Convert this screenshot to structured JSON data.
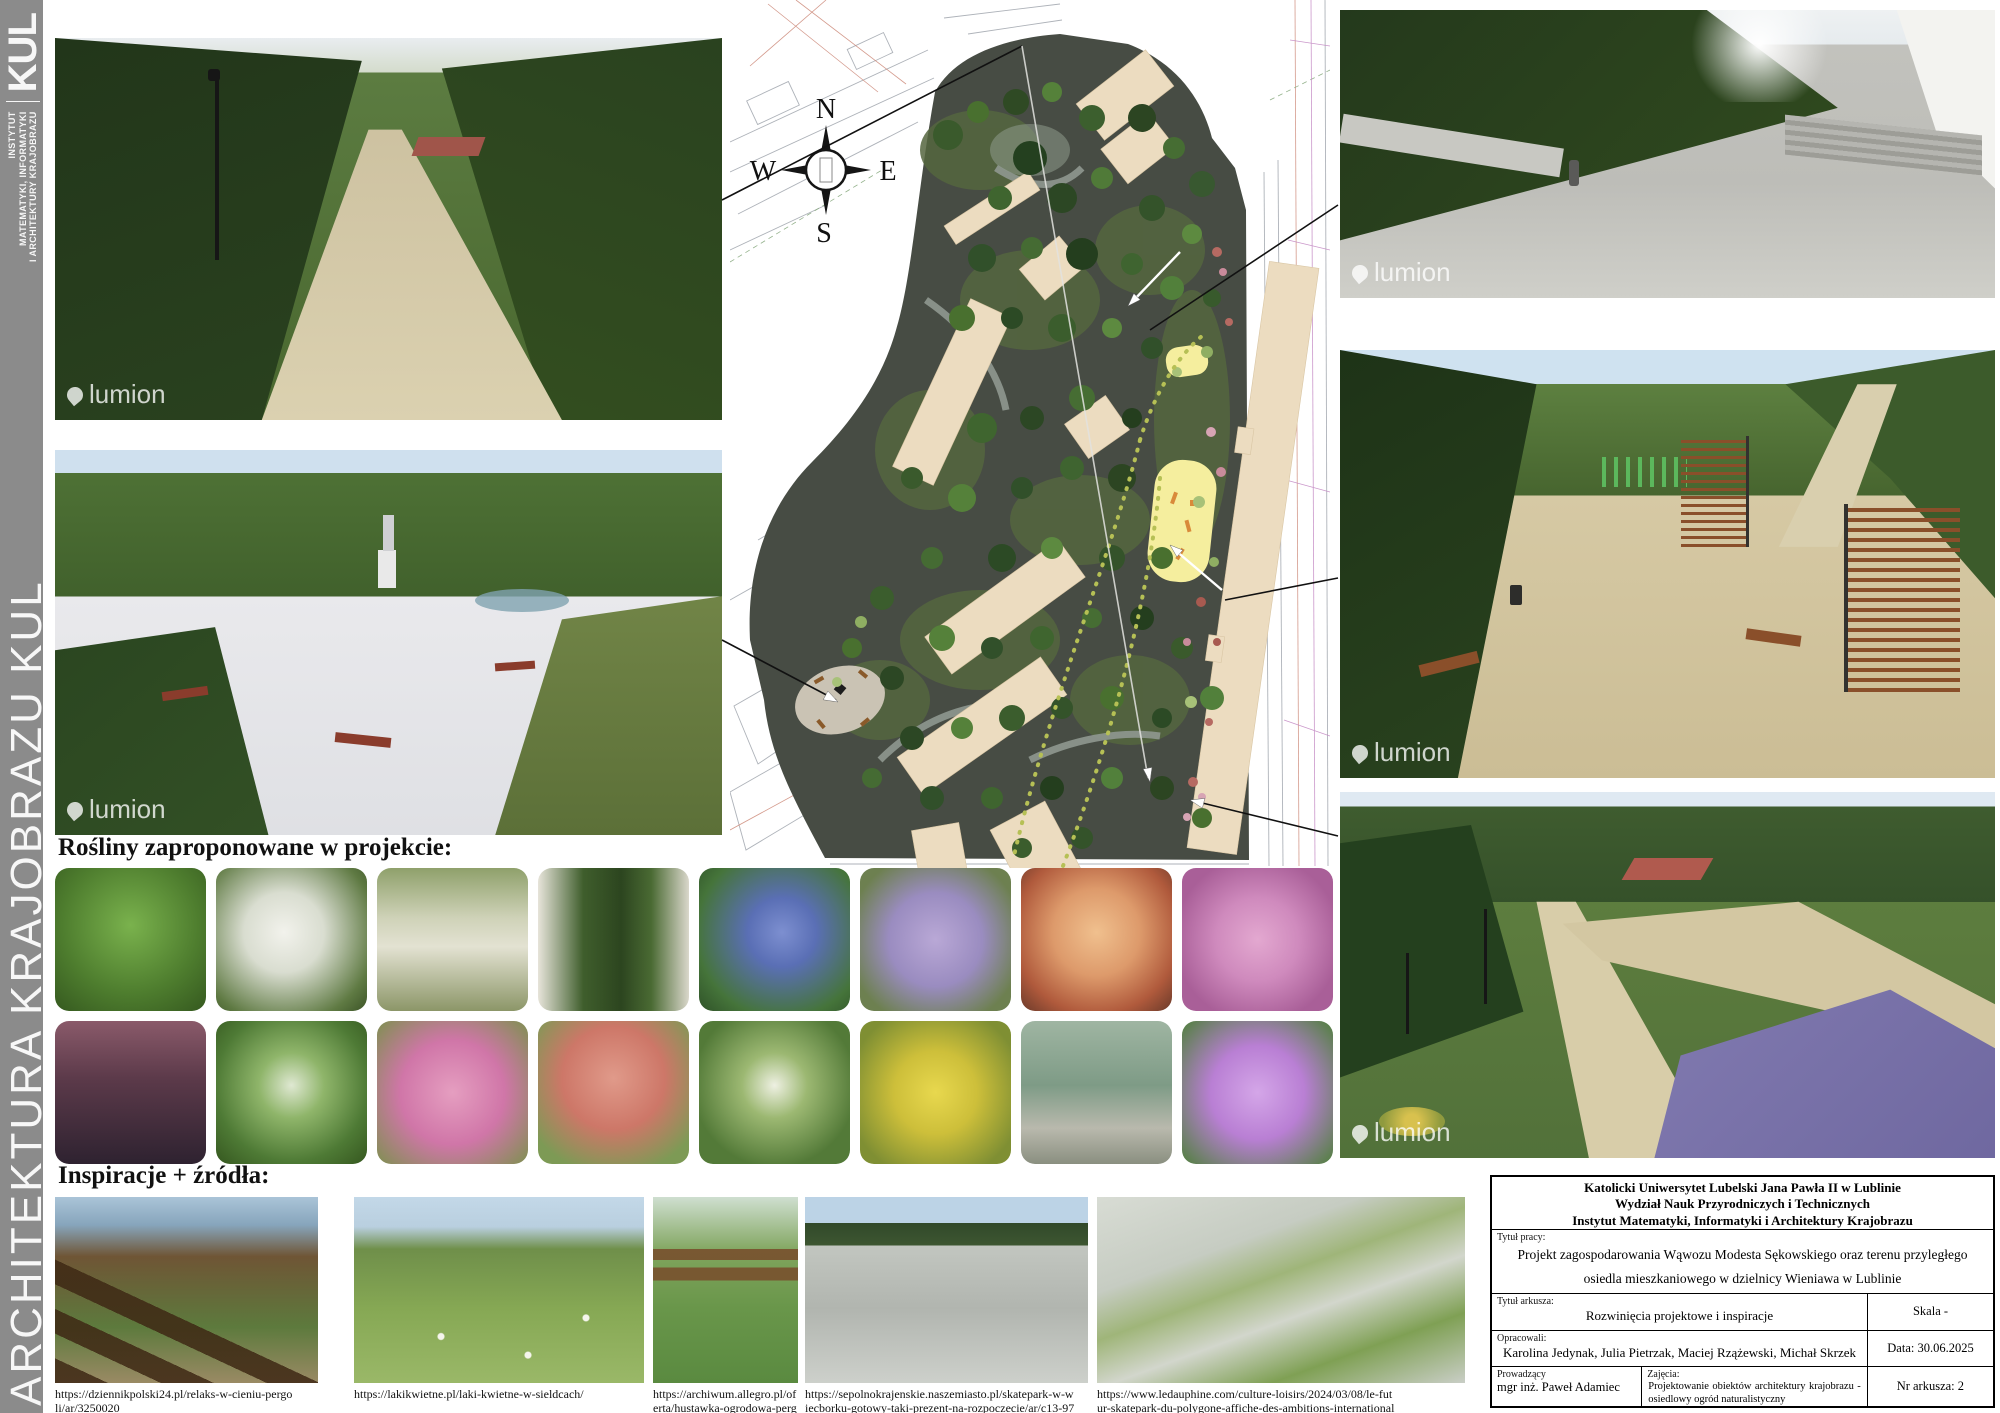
{
  "sidebar": {
    "bg_color": "#8b8b8b",
    "logo_text": "KUL",
    "institute_lines": [
      "INSTYTUT",
      "MATEMATYKI, INFORMATYKI",
      "I ARCHITEKTURY KRAJOBRAZU"
    ],
    "vertical_title": "ARCHITEKTURA KRAJOBRAZU KUL"
  },
  "headings": {
    "plants": "Rośliny zaproponowane w projekcie:",
    "inspirations": "Inspiracje + źródła:"
  },
  "compass": {
    "n": "N",
    "e": "E",
    "s": "S",
    "w": "W"
  },
  "watermark_text": "lumion",
  "plan_colors": {
    "ground": "#474c44",
    "building": "#ecdcc0",
    "play_area": "#f5ee9e",
    "dotted_path": "#b6c055"
  },
  "plants": {
    "tiles": [
      {
        "name": "green-ornamental-grass",
        "style": "background:radial-gradient(circle at 50% 40%,#7ab24d 0%,#4e7d2e 60%,#35591f 100%)"
      },
      {
        "name": "white-rhododendron",
        "style": "background:radial-gradient(circle at 45% 45%,#f2f2ec 0%,#d9ddd0 35%,#5f7a43 80%,#3c5427 100%)"
      },
      {
        "name": "silver-feather-grass",
        "style": "background:linear-gradient(180deg,#8fa06b 0%,#cfd2b8 35%,#e3e2d2 55%,#8c9668 100%)"
      },
      {
        "name": "ivy-covered-trunk",
        "style": "background:linear-gradient(90deg,#e7e4da 0%,#3f5e2c 30%,#2c451f 55%,#4a6a33 75%,#dad7cb 100%)"
      },
      {
        "name": "blue-periwinkle",
        "style": "background:radial-gradient(circle at 55% 45%,#7d8fd0 0%,#5a6fb5 30%,#45743a 75%,#2f5228 100%)"
      },
      {
        "name": "lilac-thyme-carpet",
        "style": "background:radial-gradient(circle at 50% 50%,#b9a8d6 0%,#9a8cc0 45%,#6d8050 85%)"
      },
      {
        "name": "peach-heuchera",
        "style": "background:radial-gradient(circle at 50% 45%,#f0c08e 0%,#dd9a6b 40%,#b05a3c 75%,#6b3a2a 100%)"
      },
      {
        "name": "pink-flower-carpet",
        "style": "background:radial-gradient(circle at 50% 50%,#e3a8d0 0%,#cf8abd 40%,#a95f98 80%)"
      },
      {
        "name": "dark-purple-heuchera",
        "style": "background:linear-gradient(180deg,#8a5a6a 0%,#5c3a4a 40%,#2e2230 100%)"
      },
      {
        "name": "variegated-hosta",
        "style": "background:radial-gradient(circle at 50% 45%,#dfe8d2 0%,#8fb56a 30%,#4e7a35 70%,#35571f 100%)"
      },
      {
        "name": "pink-groundcover",
        "style": "background:radial-gradient(circle at 50% 50%,#e59ec0 0%,#d076a8 50%,#7e9050 100%)"
      },
      {
        "name": "sedum-flower-heads",
        "style": "background:radial-gradient(circle at 50% 40%,#e09a8a 0%,#cd7768 45%,#7d9a55 85%)"
      },
      {
        "name": "white-flowering-shrub",
        "style": "background:radial-gradient(circle at 50% 45%,#eef0e2 0%,#9cb872 30%,#537a38 75%)"
      },
      {
        "name": "golden-euonymus",
        "style": "background:radial-gradient(circle at 50% 50%,#e8d84e 0%,#cdbf3a 40%,#7f8f33 85%)"
      },
      {
        "name": "blue-juniper-cascade",
        "style": "background:linear-gradient(180deg,#9fb5a2 0%,#7e9b86 45%,#b9b9ad 75%,#8a8f80 100%)"
      },
      {
        "name": "purple-rhododendron-bloom",
        "style": "background:radial-gradient(circle at 50% 50%,#d4a6e8 0%,#b97fd4 45%,#59804a 95%)"
      }
    ]
  },
  "inspirations": {
    "items": [
      {
        "desc": "wooden-pergola-with-benches",
        "style": "background:linear-gradient(25deg,rgba(62,40,20,.85) 0 8%,transparent 8% 16%,rgba(62,40,20,.85) 16% 24%,transparent 24% 32%,rgba(62,40,20,.85) 32% 40%,transparent 40%),linear-gradient(180deg,#aac4d8 0%,#87a5bc 15%,#6f5535 32%,#5d7a3d 70%,#9a8a64 100%)",
        "url": "https://dziennikpolski24.pl/relaks-w-cieniu-pergoli/ar/3250020"
      },
      {
        "desc": "flower-meadow-with-city-block",
        "style": "background:radial-gradient(circle at 30% 75%,#f5f5ec 3px,transparent 4px),radial-gradient(circle at 60% 85%,#f5f5ec 3px,transparent 4px),radial-gradient(circle at 80% 65%,#f5f5ec 3px,transparent 4px),linear-gradient(180deg,#c3d8e8 0%,#b9cfdf 16%,#6f8f4a 28%,#86a854 60%,#9ab868 100%)",
        "url": "https://lakikwietne.pl/laki-kwietne-w-sieldcach/"
      },
      {
        "desc": "wooden-garden-swing-pergola",
        "style": "background:linear-gradient(0deg,transparent 0 55%,rgba(120,80,45,.9) 55% 62%,transparent 62% 66%,rgba(120,80,45,.9) 66% 72%,transparent 72%),linear-gradient(180deg,#cfdfd0 0%,#7fa45c 30%,#69964a 60%,#5a8a40 100%)",
        "url": "https://archiwum.allegro.pl/oferta/hustawka-ogrodowa-pergola-i7901137468.html"
      },
      {
        "desc": "concrete-skatepark-ramps",
        "style": "background:linear-gradient(180deg,#bcd3e6 0%,#bcd3e6 14%,#31492a 14%,#3d5631 26%,#c2c6c0 26%,#b1b5af 60%,#cdd0cb 100%)",
        "url": "https://sepolnokrajenskie.naszemiasto.pl/skatepark-w-wiecborku-gotowy-taki-prezent-na-rozpoczecie/ar/c13-9735003"
      },
      {
        "desc": "aerial-view-skatepark-park",
        "style": "background:linear-gradient(160deg,#d8dcd4 0%,#c6ccc2 30%,#9fb579 45%,#d2d6cc 60%,#7fa054 78%,#c9cec6 100%)",
        "url": "https://www.ledauphine.com/culture-loisirs/2024/03/08/le-futur-skatepark-du-polygone-affiche-des-ambitions-internationales"
      }
    ]
  },
  "titleblock": {
    "university_lines": [
      "Katolicki Uniwersytet Lubelski Jana Pawła II w Lublinie",
      "Wydział Nauk Przyrodniczych i Technicznych",
      "Instytut Matematyki, Informatyki i Architektury Krajobrazu"
    ],
    "label_project_title": "Tytuł pracy:",
    "project_title": "Projekt zagospodarowania Wąwozu Modesta Sękowskiego oraz terenu przyległego osiedla mieszkaniowego w dzielnicy Wieniawa w Lublinie",
    "label_sheet_title": "Tytuł arkusza:",
    "sheet_title": "Rozwinięcia projektowe i inspiracje",
    "scale": "Skala -",
    "label_authors": "Opracowali:",
    "authors": "Karolina Jedynak, Julia Pietrzak, Maciej Rzążewski, Michał Skrzek",
    "date": "Data: 30.06.2025",
    "label_supervisor": "Prowadzący",
    "supervisor": "mgr inż. Paweł Adamiec",
    "label_course": "Zajęcia:",
    "course": "Projektowanie obiektów architektury krajobrazu - osiedlowy ogród naturalistyczny",
    "sheet_no": "Nr arkusza: 2"
  }
}
